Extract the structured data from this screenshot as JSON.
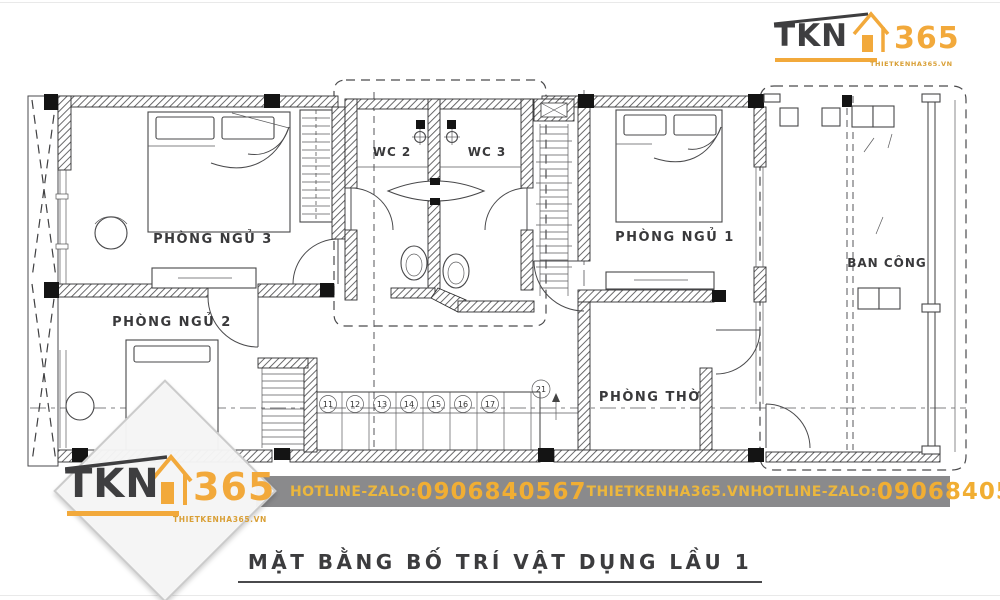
{
  "brand": {
    "name": "TKN",
    "number": "365",
    "website": "THIETKENHA365.VN"
  },
  "plan": {
    "rooms": {
      "bedroom3": "PHÒNG NGỦ 3",
      "bedroom2": "PHÒNG NGỦ 2",
      "bedroom1": "PHÒNG NGỦ 1",
      "wc2": "WC 2",
      "wc3": "WC 3",
      "balcony": "BAN CÔNG",
      "worship": "PHÒNG THỜ"
    },
    "stairs": {
      "steps": [
        "11",
        "12",
        "13",
        "14",
        "15",
        "16",
        "17"
      ],
      "landing": "21"
    }
  },
  "footer": {
    "hotline_label": "HOTLINE-ZALO:",
    "phone": "0906840567",
    "website": "THIETKENHA365.VN",
    "hotline_label2": "HOTLINE-ZALO:",
    "phone2": "0906840567"
  },
  "title": "MẶT BẰNG BỐ TRÍ VẬT DỤNG LẦU 1",
  "colors": {
    "accent_orange": "#F2A93B",
    "logo_dark": "#3E3E40",
    "footer_gray": "#8A8A8C",
    "footer_yellow": "#ECB73D",
    "ink": "#3A3A3A"
  }
}
